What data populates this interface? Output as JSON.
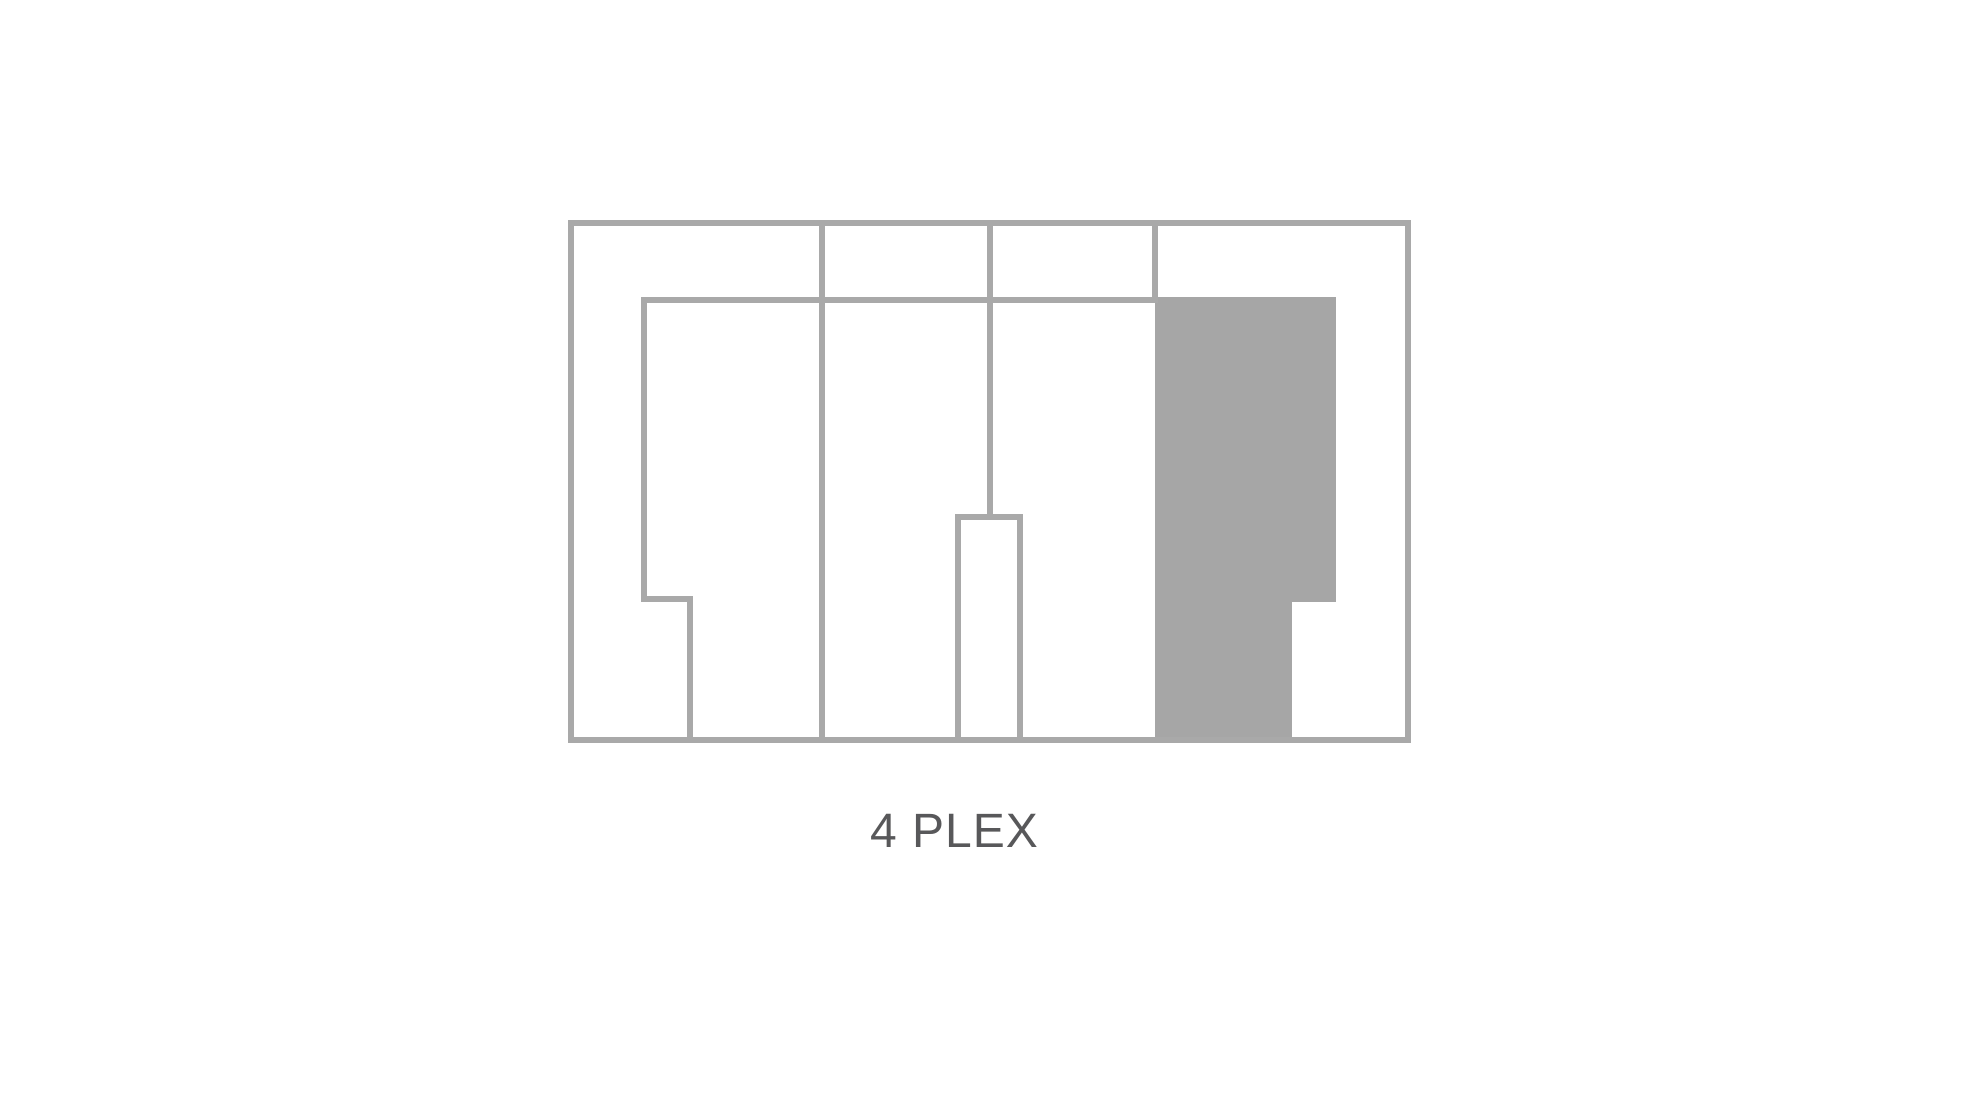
{
  "diagram": {
    "label": "4 PLEX",
    "type": "floor-plan",
    "units": [
      {
        "id": "unit-1",
        "highlighted": false
      },
      {
        "id": "unit-2",
        "highlighted": false
      },
      {
        "id": "unit-3",
        "highlighted": false
      },
      {
        "id": "unit-4",
        "highlighted": true
      }
    ]
  },
  "colors": {
    "background": "#ffffff",
    "line": "#a9a9a9",
    "highlight": "#a6a6a6",
    "label": "#58585a"
  }
}
